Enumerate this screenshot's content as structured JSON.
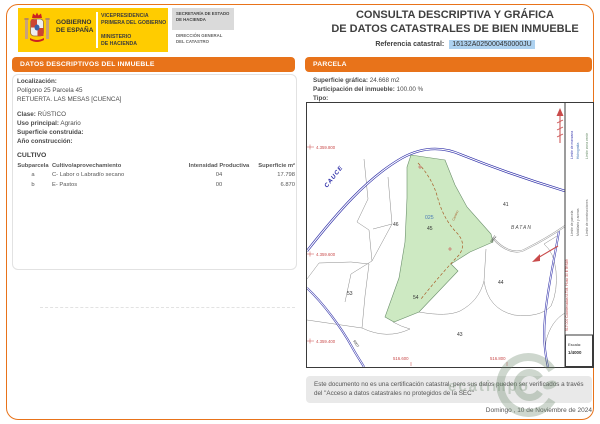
{
  "header": {
    "government": {
      "name": "GOBIERNO\nDE ESPAÑA",
      "vicepresidency": "VICEPRESIDENCIA\nPRIMERA DEL GOBIERNO",
      "ministry": "MINISTERIO\nDE HACIENDA",
      "secretary": "SECRETARÍA DE ESTADO\nDE HACIENDA",
      "directorate": "DIRECCIÓN GENERAL\nDEL CATASTRO"
    },
    "title_line1": "CONSULTA DESCRIPTIVA Y GRÁFICA",
    "title_line2": "DE DATOS CATASTRALES DE BIEN INMUEBLE",
    "ref_label": "Referencia catastral:",
    "ref_value": "16132A025000450000JU"
  },
  "left_panel": {
    "title": "DATOS DESCRIPTIVOS DEL INMUEBLE",
    "localizacion_label": "Localización:",
    "localizacion_line1": "Polígono 25 Parcela 45",
    "localizacion_line2": "RETUERTA. LAS MESAS [CUENCA]",
    "clase_label": "Clase:",
    "clase_value": "RÚSTICO",
    "uso_label": "Uso principal:",
    "uso_value": "Agrario",
    "superficie_label": "Superficie construida:",
    "anio_label": "Año construcción:",
    "cultivo": {
      "title": "CULTIVO",
      "columns": [
        "Subparcela",
        "Cultivo/aprovechamiento",
        "Intensidad Productiva",
        "Superficie m²"
      ],
      "rows": [
        [
          "a",
          "C- Labor o Labradío secano",
          "04",
          "17.798"
        ],
        [
          "b",
          "E- Pastos",
          "00",
          "6.870"
        ]
      ]
    }
  },
  "right_panel": {
    "title": "PARCELA",
    "superficie_grafica_label": "Superficie gráfica:",
    "superficie_grafica_value": "24.668 m2",
    "participacion_label": "Participación del inmueble:",
    "participacion_value": "100.00 %",
    "tipo_label": "Tipo:"
  },
  "map": {
    "coords_left": [
      "4.359.800",
      "4.359.600",
      "4.359.400"
    ],
    "coords_bottom": [
      "516.600",
      "516.800"
    ],
    "parcel_labels": [
      "46",
      "41",
      "53",
      "54",
      "43",
      "44"
    ],
    "subject_parcel": {
      "poligono": "025",
      "parcela": "45"
    },
    "place_name": "BATAN",
    "river_label": "CAUCE",
    "road_label_1": "9002",
    "road_label_2": "9007",
    "camino_label": "Camino",
    "legend_items": [
      "Límite de manzana",
      "Hidrografía",
      "Límite zona verde",
      "Límite de parcela",
      "Mobiliario y aceras",
      "Límite de construcciones"
    ],
    "utm_note": "517.000 Coordenadas U.T.M. Huso 30 ETRS89",
    "scale_label": "Escala:",
    "scale_value": "1/4000",
    "colors": {
      "parcel_fill": "#cde9c2",
      "road": "#2e2ea8",
      "coord": "#c94b4b",
      "accent": "#e8731a"
    }
  },
  "footer": {
    "disclaimer": "Este documento no es una certificación catastral, pero sus datos pueden ser verificados a través del \"Acceso a datos catastrales no protegidos de la SEC\"",
    "date": "Domingo , 10 de Noviembre de 2024",
    "watermark": "ecatimpo"
  }
}
